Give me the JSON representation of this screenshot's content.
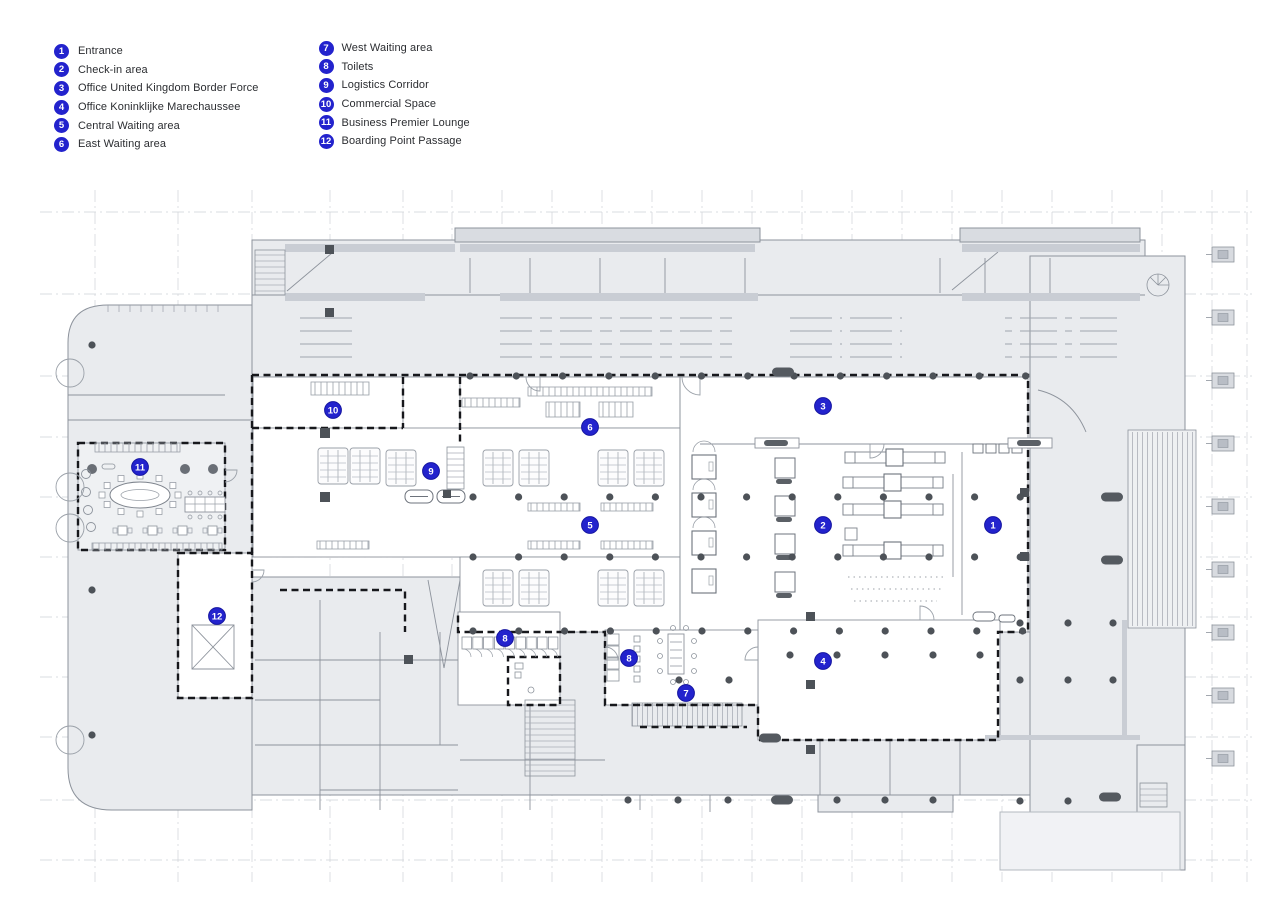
{
  "legend": {
    "columns": [
      {
        "items": [
          {
            "number": "1",
            "label": "Entrance"
          },
          {
            "number": "2",
            "label": "Check-in area"
          },
          {
            "number": "3",
            "label": "Office United Kingdom Border Force"
          },
          {
            "number": "4",
            "label": "Office Koninklijke Marechaussee"
          },
          {
            "number": "5",
            "label": "Central Waiting area"
          },
          {
            "number": "6",
            "label": "East Waiting area"
          }
        ]
      },
      {
        "items": [
          {
            "number": "7",
            "label": "West Waiting area"
          },
          {
            "number": "8",
            "label": "Toilets"
          },
          {
            "number": "9",
            "label": "Logistics Corridor"
          },
          {
            "number": "10",
            "label": "Commercial Space"
          },
          {
            "number": "11",
            "label": "Business Premier Lounge"
          },
          {
            "number": "12",
            "label": "Boarding Point Passage"
          }
        ]
      }
    ]
  },
  "plan": {
    "marker_color": "#2323cd",
    "marker_edge_color": "#1414a0",
    "markers": [
      {
        "number": "1",
        "x": 993,
        "y": 525
      },
      {
        "number": "2",
        "x": 823,
        "y": 525
      },
      {
        "number": "3",
        "x": 823,
        "y": 406
      },
      {
        "number": "4",
        "x": 823,
        "y": 661
      },
      {
        "number": "5",
        "x": 590,
        "y": 525
      },
      {
        "number": "6",
        "x": 590,
        "y": 427
      },
      {
        "number": "7",
        "x": 686,
        "y": 693
      },
      {
        "number": "8",
        "x": 505,
        "y": 638
      },
      {
        "number": "8",
        "x": 629,
        "y": 658
      },
      {
        "number": "9",
        "x": 431,
        "y": 471
      },
      {
        "number": "10",
        "x": 333,
        "y": 410
      },
      {
        "number": "11",
        "x": 140,
        "y": 467
      },
      {
        "number": "12",
        "x": 217,
        "y": 616
      }
    ]
  }
}
